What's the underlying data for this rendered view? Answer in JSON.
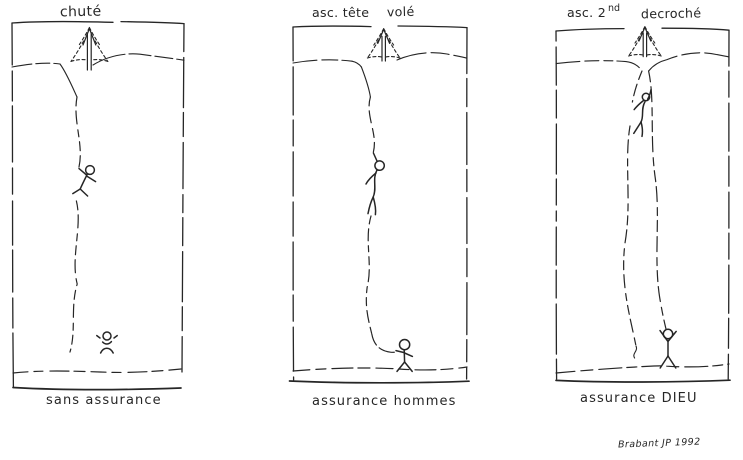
{
  "sketch": {
    "ink_color": "#262626",
    "paper_color": "#ffffff",
    "panel_fallen": {
      "top_label": "chuté",
      "caption": "sans assurance"
    },
    "panel_lead": {
      "top_label_left": "asc. tête",
      "top_label_right": "volé",
      "caption": "assurance hommes"
    },
    "panel_second": {
      "top_label_left": "asc. 2",
      "top_label_sup": "nd",
      "top_label_right": "decroché",
      "caption": "assurance DIEU"
    },
    "signature": "Brabant JP 1992"
  }
}
